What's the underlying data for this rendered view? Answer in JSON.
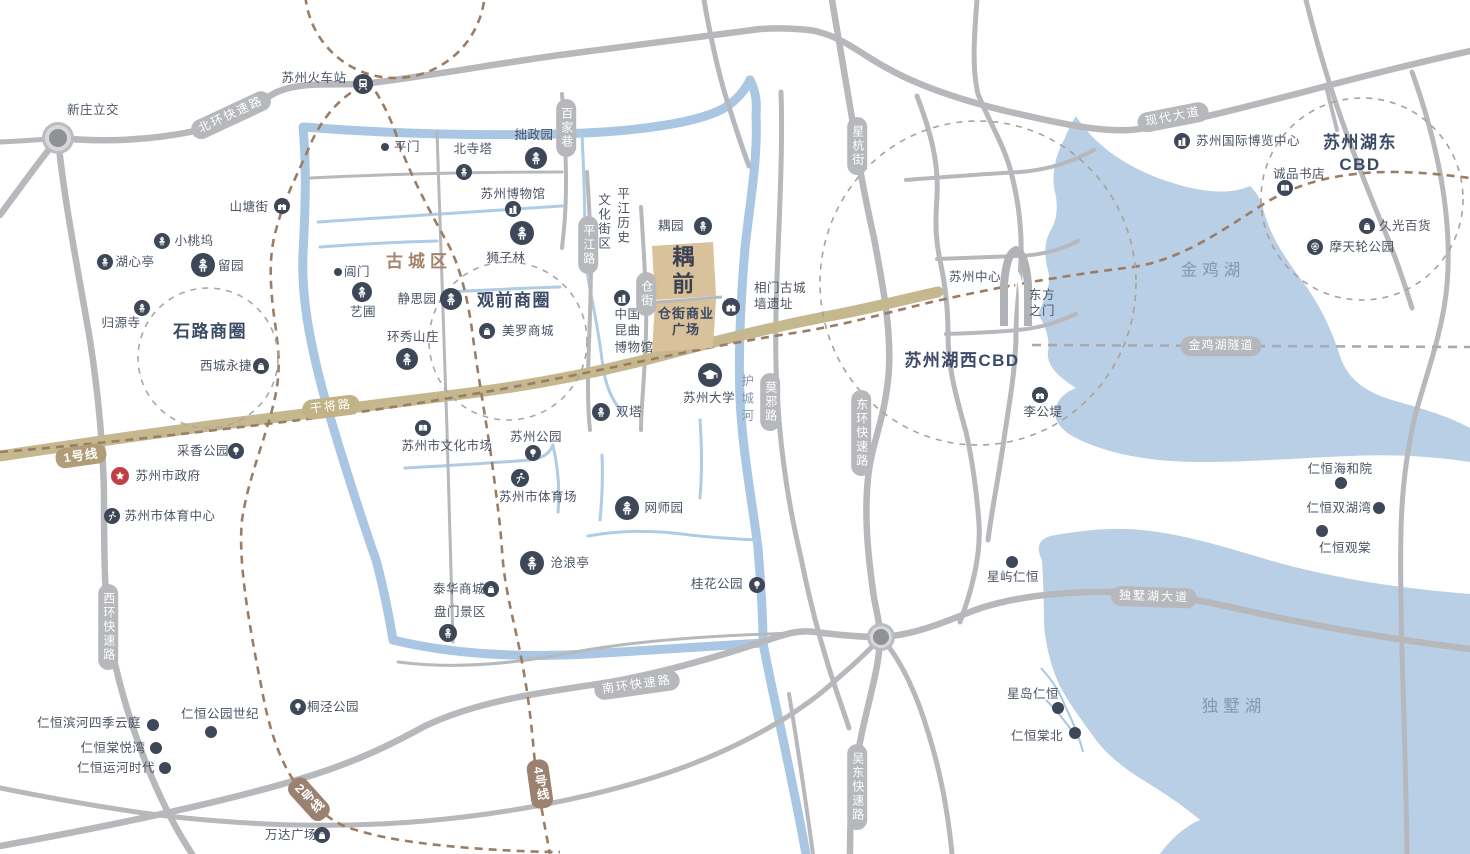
{
  "labels": [
    {
      "id": "xinzhuang-interchange",
      "t": "新庄立交",
      "x": 93,
      "y": 110
    },
    {
      "id": "suzhou-railway-station",
      "t": "苏州火车站",
      "x": 314,
      "y": 78
    },
    {
      "id": "pingmen",
      "t": "平门",
      "x": 407,
      "y": 147
    },
    {
      "id": "beisita",
      "t": "北寺塔",
      "x": 473,
      "y": 149
    },
    {
      "id": "zhuozhengyuan",
      "t": "拙政园",
      "x": 534,
      "y": 135
    },
    {
      "id": "suzhou-museum",
      "t": "苏州博物馆",
      "x": 513,
      "y": 194
    },
    {
      "id": "shizilin",
      "t": "狮子林",
      "x": 506,
      "y": 258
    },
    {
      "id": "shantangjie",
      "t": "山塘街",
      "x": 249,
      "y": 207
    },
    {
      "id": "xiaotaowu",
      "t": "小桃坞",
      "x": 194,
      "y": 241
    },
    {
      "id": "huxinting",
      "t": "湖心亭",
      "x": 135,
      "y": 262
    },
    {
      "id": "liuyuan",
      "t": "留园",
      "x": 231,
      "y": 266
    },
    {
      "id": "changmen",
      "t": "阊门",
      "x": 357,
      "y": 272
    },
    {
      "id": "yipu",
      "t": "艺圃",
      "x": 363,
      "y": 312
    },
    {
      "id": "jingsiyuan",
      "t": "静思园",
      "x": 417,
      "y": 299
    },
    {
      "id": "huanxiushanzhuang",
      "t": "环秀山庄",
      "x": 413,
      "y": 337
    },
    {
      "id": "gucheng-district",
      "t": "古城区",
      "x": 419,
      "y": 262,
      "cls": "dist"
    },
    {
      "id": "shilu-circle",
      "t": "石路商圈",
      "x": 210,
      "y": 332,
      "cls": "big"
    },
    {
      "id": "xicheng-yongjie",
      "t": "西城永捷",
      "x": 226,
      "y": 366
    },
    {
      "id": "guiyuansi",
      "t": "归源寺",
      "x": 121,
      "y": 323
    },
    {
      "id": "guanqian-circle",
      "t": "观前商圈",
      "x": 514,
      "y": 301,
      "cls": "big"
    },
    {
      "id": "meiluo-mall",
      "t": "美罗商城",
      "x": 528,
      "y": 331
    },
    {
      "id": "caixiang-park",
      "t": "采香公园",
      "x": 203,
      "y": 451
    },
    {
      "id": "suzhou-government",
      "t": "苏州市政府",
      "x": 168,
      "y": 476
    },
    {
      "id": "sports-center",
      "t": "苏州市体育中心",
      "x": 170,
      "y": 516
    },
    {
      "id": "culture-market",
      "t": "苏州市文化市场",
      "x": 447,
      "y": 446
    },
    {
      "id": "suzhou-park",
      "t": "苏州公园",
      "x": 536,
      "y": 437
    },
    {
      "id": "city-stadium",
      "t": "苏州市体育场",
      "x": 538,
      "y": 497
    },
    {
      "id": "shuangta",
      "t": "双塔",
      "x": 629,
      "y": 412
    },
    {
      "id": "wangshiyuan",
      "t": "网师园",
      "x": 664,
      "y": 508
    },
    {
      "id": "canglangting",
      "t": "沧浪亭",
      "x": 570,
      "y": 563
    },
    {
      "id": "taihua-mall",
      "t": "泰华商城",
      "x": 459,
      "y": 589
    },
    {
      "id": "panmen",
      "t": "盘门景区",
      "x": 460,
      "y": 612
    },
    {
      "id": "guihua-park",
      "t": "桂花公园",
      "x": 717,
      "y": 584
    },
    {
      "id": "suzhou-university",
      "t": "苏州大学",
      "x": 709,
      "y": 398
    },
    {
      "id": "xiangmen-wall",
      "t": "相门古城\n墙遗址",
      "x": 780,
      "y": 296,
      "cls": "lbl la"
    },
    {
      "id": "ouyuan",
      "t": "耦园",
      "x": 671,
      "y": 226
    },
    {
      "id": "kunqu-museum",
      "t": "中国\n昆曲\n博物馆",
      "x": 634,
      "y": 331,
      "cls": "lbl la"
    },
    {
      "id": "cangjie-plaza",
      "t": "仓街商业\n广场",
      "x": 686,
      "y": 322,
      "cls": "plaza"
    },
    {
      "id": "project-logo",
      "t": "耦前",
      "x": 681,
      "y": 272,
      "cls": "logo"
    },
    {
      "id": "suzhou-center",
      "t": "苏州中心",
      "x": 975,
      "y": 277
    },
    {
      "id": "dongfangzhimen",
      "t": "东方\n之门",
      "x": 1042,
      "y": 303
    },
    {
      "id": "huxi-cbd",
      "t": "苏州湖西CBD",
      "x": 962,
      "y": 361,
      "cls": "big"
    },
    {
      "id": "ligongdi",
      "t": "李公堤",
      "x": 1043,
      "y": 412
    },
    {
      "id": "jinji-lake",
      "t": "金鸡湖",
      "x": 1213,
      "y": 271,
      "cls": "lake"
    },
    {
      "id": "expo-center",
      "t": "苏州国际博览中心",
      "x": 1248,
      "y": 141
    },
    {
      "id": "hudong-cbd",
      "t": "苏州湖东CBD",
      "x": 1360,
      "y": 154,
      "cls": "big"
    },
    {
      "id": "chengpin-bookstore",
      "t": "诚品书店",
      "x": 1299,
      "y": 174
    },
    {
      "id": "jiuguang",
      "t": "久光百货",
      "x": 1405,
      "y": 226
    },
    {
      "id": "ferris-wheel-park",
      "t": "摩天轮公园",
      "x": 1362,
      "y": 247
    },
    {
      "id": "haiheyuan",
      "t": "仁恒海和院",
      "x": 1340,
      "y": 469
    },
    {
      "id": "shuanghuwan",
      "t": "仁恒双湖湾",
      "x": 1339,
      "y": 508
    },
    {
      "id": "guantang",
      "t": "仁恒观棠",
      "x": 1345,
      "y": 548
    },
    {
      "id": "xingyu-renheng",
      "t": "星屿仁恒",
      "x": 1013,
      "y": 577
    },
    {
      "id": "xingdao-renheng",
      "t": "星岛仁恒",
      "x": 1033,
      "y": 694
    },
    {
      "id": "tangbei",
      "t": "仁恒棠北",
      "x": 1037,
      "y": 736
    },
    {
      "id": "dushu-lake",
      "t": "独墅湖",
      "x": 1234,
      "y": 707,
      "cls": "lake"
    },
    {
      "id": "binhe-siji",
      "t": "仁恒滨河四季云庭",
      "x": 89,
      "y": 723
    },
    {
      "id": "tangyuewan",
      "t": "仁恒棠悦湾",
      "x": 113,
      "y": 748
    },
    {
      "id": "yunhe-shidai",
      "t": "仁恒运河时代",
      "x": 116,
      "y": 768
    },
    {
      "id": "gongyuan-shiji",
      "t": "仁恒公园世纪",
      "x": 220,
      "y": 714
    },
    {
      "id": "tongjing-park",
      "t": "桐泾公园",
      "x": 333,
      "y": 707
    },
    {
      "id": "wanda-plaza",
      "t": "万达广场",
      "x": 291,
      "y": 835
    },
    {
      "id": "moat-huchenghe",
      "t": "护城河",
      "x": 746,
      "y": 400,
      "cls": "moatlbl"
    },
    {
      "id": "pingjiang-history-1",
      "t": "平江历史",
      "x": 622,
      "y": 216,
      "cls": "vcol"
    },
    {
      "id": "pingjiang-history-2",
      "t": "文化街区",
      "x": 603,
      "y": 222,
      "cls": "vcol"
    }
  ],
  "pills": [
    {
      "id": "north-ring-road",
      "t": "北环快速路",
      "x": 231,
      "y": 115,
      "rot": -25
    },
    {
      "id": "west-ring-road",
      "t": "西环快速路",
      "x": 108,
      "y": 627,
      "vert": true
    },
    {
      "id": "south-ring-road",
      "t": "南环快速路",
      "x": 637,
      "y": 685,
      "rot": -8
    },
    {
      "id": "east-ring-road",
      "t": "东环快速路",
      "x": 861,
      "y": 433,
      "vert": true
    },
    {
      "id": "wudong-road",
      "t": "吴东快速路",
      "x": 857,
      "y": 787,
      "vert": true
    },
    {
      "id": "xinghang-street",
      "t": "星杭街",
      "x": 857,
      "y": 146,
      "vert": true
    },
    {
      "id": "moye-road",
      "t": "莫邪路",
      "x": 770,
      "y": 402,
      "vert": true
    },
    {
      "id": "baijiaxiang",
      "t": "百家巷",
      "x": 566,
      "y": 128,
      "vert": true
    },
    {
      "id": "pingjiang-road",
      "t": "平江路",
      "x": 588,
      "y": 245,
      "vert": true
    },
    {
      "id": "cangjie-street",
      "t": "仓街",
      "x": 646,
      "y": 294,
      "vert": true
    },
    {
      "id": "modern-avenue",
      "t": "现代大道",
      "x": 1173,
      "y": 117,
      "rot": -11
    },
    {
      "id": "dushu-lake-avenue",
      "t": "独墅湖大道",
      "x": 1154,
      "y": 597,
      "rot": 2
    },
    {
      "id": "jinji-lake-tunnel",
      "t": "金鸡湖隧道",
      "x": 1221,
      "y": 346,
      "style": "tunnel"
    },
    {
      "id": "ganjiang-road",
      "t": "干将路",
      "x": 331,
      "y": 407,
      "rot": -7,
      "style": "tan"
    }
  ],
  "badges": [
    {
      "id": "metro-line-1",
      "t": "1号线",
      "x": 81,
      "y": 456,
      "rot": -8
    },
    {
      "id": "metro-line-2",
      "t": "2号线",
      "x": 309,
      "y": 799,
      "rot": -42,
      "vert": true,
      "style": "brown"
    },
    {
      "id": "metro-line-4",
      "t": "4号线",
      "x": 540,
      "y": 784,
      "rot": -8,
      "vert": true,
      "style": "brown"
    }
  ],
  "icons": [
    {
      "id": "railway-station-icon",
      "g": "train",
      "x": 363,
      "y": 84,
      "r": 10
    },
    {
      "id": "pingmen-dot",
      "g": "dot",
      "x": 385,
      "y": 147,
      "r": 4
    },
    {
      "id": "changmen-dot",
      "g": "dot",
      "x": 338,
      "y": 272,
      "r": 4
    },
    {
      "id": "beisita-icon",
      "g": "pagoda",
      "x": 464,
      "y": 172,
      "r": 8
    },
    {
      "id": "zhuozhengyuan-icon",
      "g": "pagoda",
      "x": 536,
      "y": 158,
      "r": 11
    },
    {
      "id": "suzhou-museum-icon",
      "g": "building",
      "x": 513,
      "y": 209,
      "r": 8
    },
    {
      "id": "shizilin-icon",
      "g": "pagoda",
      "x": 522,
      "y": 233,
      "r": 12
    },
    {
      "id": "shantangjie-icon",
      "g": "wall",
      "x": 282,
      "y": 206,
      "r": 8
    },
    {
      "id": "xiaotaowu-icon",
      "g": "pagoda",
      "x": 162,
      "y": 241,
      "r": 8
    },
    {
      "id": "huxinting-icon",
      "g": "pagoda",
      "x": 105,
      "y": 262,
      "r": 8
    },
    {
      "id": "liuyuan-icon",
      "g": "pagoda",
      "x": 203,
      "y": 265,
      "r": 12
    },
    {
      "id": "yipu-icon",
      "g": "pagoda",
      "x": 362,
      "y": 292,
      "r": 10
    },
    {
      "id": "jingsiyuan-icon",
      "g": "pagoda",
      "x": 451,
      "y": 299,
      "r": 11
    },
    {
      "id": "huanxiu-icon",
      "g": "pagoda",
      "x": 407,
      "y": 359,
      "r": 11
    },
    {
      "id": "xicheng-icon",
      "g": "bag",
      "x": 261,
      "y": 366,
      "r": 8
    },
    {
      "id": "guiyuansi-icon",
      "g": "pagoda",
      "x": 142,
      "y": 308,
      "r": 8
    },
    {
      "id": "meiluo-icon",
      "g": "bag",
      "x": 487,
      "y": 331,
      "r": 8
    },
    {
      "id": "caixiang-icon",
      "g": "tree",
      "x": 236,
      "y": 451,
      "r": 8
    },
    {
      "id": "government-icon",
      "g": "star",
      "x": 120,
      "y": 476,
      "r": 9,
      "bg": "#bf3f47"
    },
    {
      "id": "sports-center-icon",
      "g": "runner",
      "x": 112,
      "y": 516,
      "r": 8
    },
    {
      "id": "culture-market-icon",
      "g": "book",
      "x": 423,
      "y": 428,
      "r": 8
    },
    {
      "id": "suzhou-park-icon",
      "g": "tree",
      "x": 533,
      "y": 453,
      "r": 8
    },
    {
      "id": "stadium-icon",
      "g": "runner",
      "x": 520,
      "y": 478,
      "r": 9
    },
    {
      "id": "shuangta-icon",
      "g": "pagoda",
      "x": 601,
      "y": 412,
      "r": 9
    },
    {
      "id": "wangshiyuan-icon",
      "g": "pagoda",
      "x": 627,
      "y": 508,
      "r": 12
    },
    {
      "id": "canglangting-icon",
      "g": "pagoda",
      "x": 532,
      "y": 563,
      "r": 12
    },
    {
      "id": "taihua-icon",
      "g": "bag",
      "x": 491,
      "y": 589,
      "r": 8
    },
    {
      "id": "panmen-icon",
      "g": "pagoda",
      "x": 448,
      "y": 633,
      "r": 9
    },
    {
      "id": "guihua-icon",
      "g": "tree",
      "x": 757,
      "y": 585,
      "r": 8
    },
    {
      "id": "university-icon",
      "g": "cap",
      "x": 710,
      "y": 375,
      "r": 12
    },
    {
      "id": "xiangmen-icon",
      "g": "wall",
      "x": 731,
      "y": 307,
      "r": 9
    },
    {
      "id": "ouyuan-icon",
      "g": "pagoda",
      "x": 703,
      "y": 226,
      "r": 9
    },
    {
      "id": "kunqu-icon",
      "g": "building",
      "x": 622,
      "y": 298,
      "r": 8
    },
    {
      "id": "ligongdi-icon",
      "g": "wall",
      "x": 1040,
      "y": 395,
      "r": 8
    },
    {
      "id": "expo-icon",
      "g": "building",
      "x": 1182,
      "y": 141,
      "r": 8
    },
    {
      "id": "chengpin-icon",
      "g": "book",
      "x": 1285,
      "y": 188,
      "r": 8
    },
    {
      "id": "jiuguang-icon",
      "g": "bag",
      "x": 1367,
      "y": 226,
      "r": 8
    },
    {
      "id": "ferris-icon",
      "g": "wheel",
      "x": 1315,
      "y": 247,
      "r": 8
    },
    {
      "id": "tongjing-icon",
      "g": "tree",
      "x": 298,
      "y": 707,
      "r": 8
    },
    {
      "id": "wanda-icon",
      "g": "bag",
      "x": 322,
      "y": 835,
      "r": 8
    },
    {
      "id": "binhe-dot",
      "g": "dot",
      "x": 153,
      "y": 725,
      "r": 6
    },
    {
      "id": "tangyuewan-dot",
      "g": "dot",
      "x": 156,
      "y": 748,
      "r": 6
    },
    {
      "id": "yunhe-dot",
      "g": "dot",
      "x": 165,
      "y": 768,
      "r": 6
    },
    {
      "id": "gongyuan-shiji-dot",
      "g": "dot",
      "x": 211,
      "y": 732,
      "r": 6
    },
    {
      "id": "haiheyuan-dot",
      "g": "dot",
      "x": 1341,
      "y": 483,
      "r": 6
    },
    {
      "id": "shuanghuwan-dot",
      "g": "dot",
      "x": 1379,
      "y": 508,
      "r": 6
    },
    {
      "id": "guantang-dot",
      "g": "dot",
      "x": 1322,
      "y": 531,
      "r": 6
    },
    {
      "id": "xingyu-dot",
      "g": "dot",
      "x": 1012,
      "y": 562,
      "r": 6
    },
    {
      "id": "xingdao-dot",
      "g": "dot",
      "x": 1058,
      "y": 708,
      "r": 6
    },
    {
      "id": "tangbei-dot",
      "g": "dot",
      "x": 1075,
      "y": 733,
      "r": 6
    }
  ],
  "colors": {
    "road": "#b7b8bb",
    "water": "#b8cfe6",
    "canal": "#a9c7e3",
    "tan_road": "#c5b88f",
    "metro_brown": "#9c7d64",
    "tunnel_gray": "#a7abb0",
    "navy_icon": "#3e4757",
    "accent_block": "#d8c19b",
    "gov_red": "#bf3f47",
    "circle_dash": "#aba294"
  }
}
